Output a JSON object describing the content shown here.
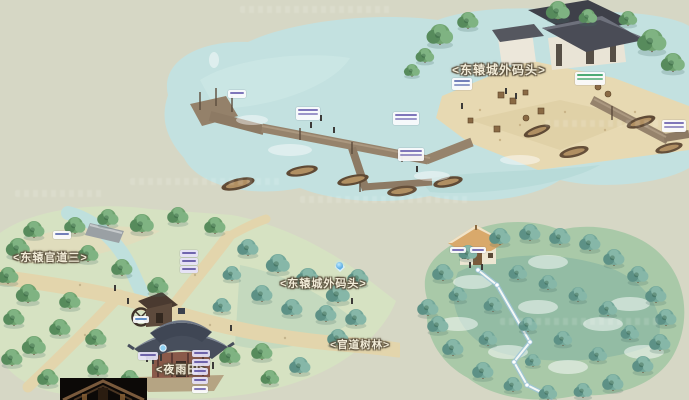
{
  "labels": {
    "harbor_title": "<东辕城外码头>",
    "road_dock": "<东辕城外码头>",
    "road_three": "<东辕官道三>",
    "road_forest": "<官道树林>",
    "field": "<夜雨田>"
  },
  "colors": {
    "background": "#d6d7c5",
    "water": "#c3e1e0",
    "sand": "#e7d9b2",
    "land": "#d6e2c2",
    "road": "#e3d5ac",
    "pier": "#8d7a64",
    "temple_roof": "#474e5c",
    "cottage_roof": "#d9a96b",
    "waypoint_blue": "#6db8e8",
    "nameplate_green": "#2f9e5f",
    "nameplate_purple": "#5a4fa0"
  }
}
